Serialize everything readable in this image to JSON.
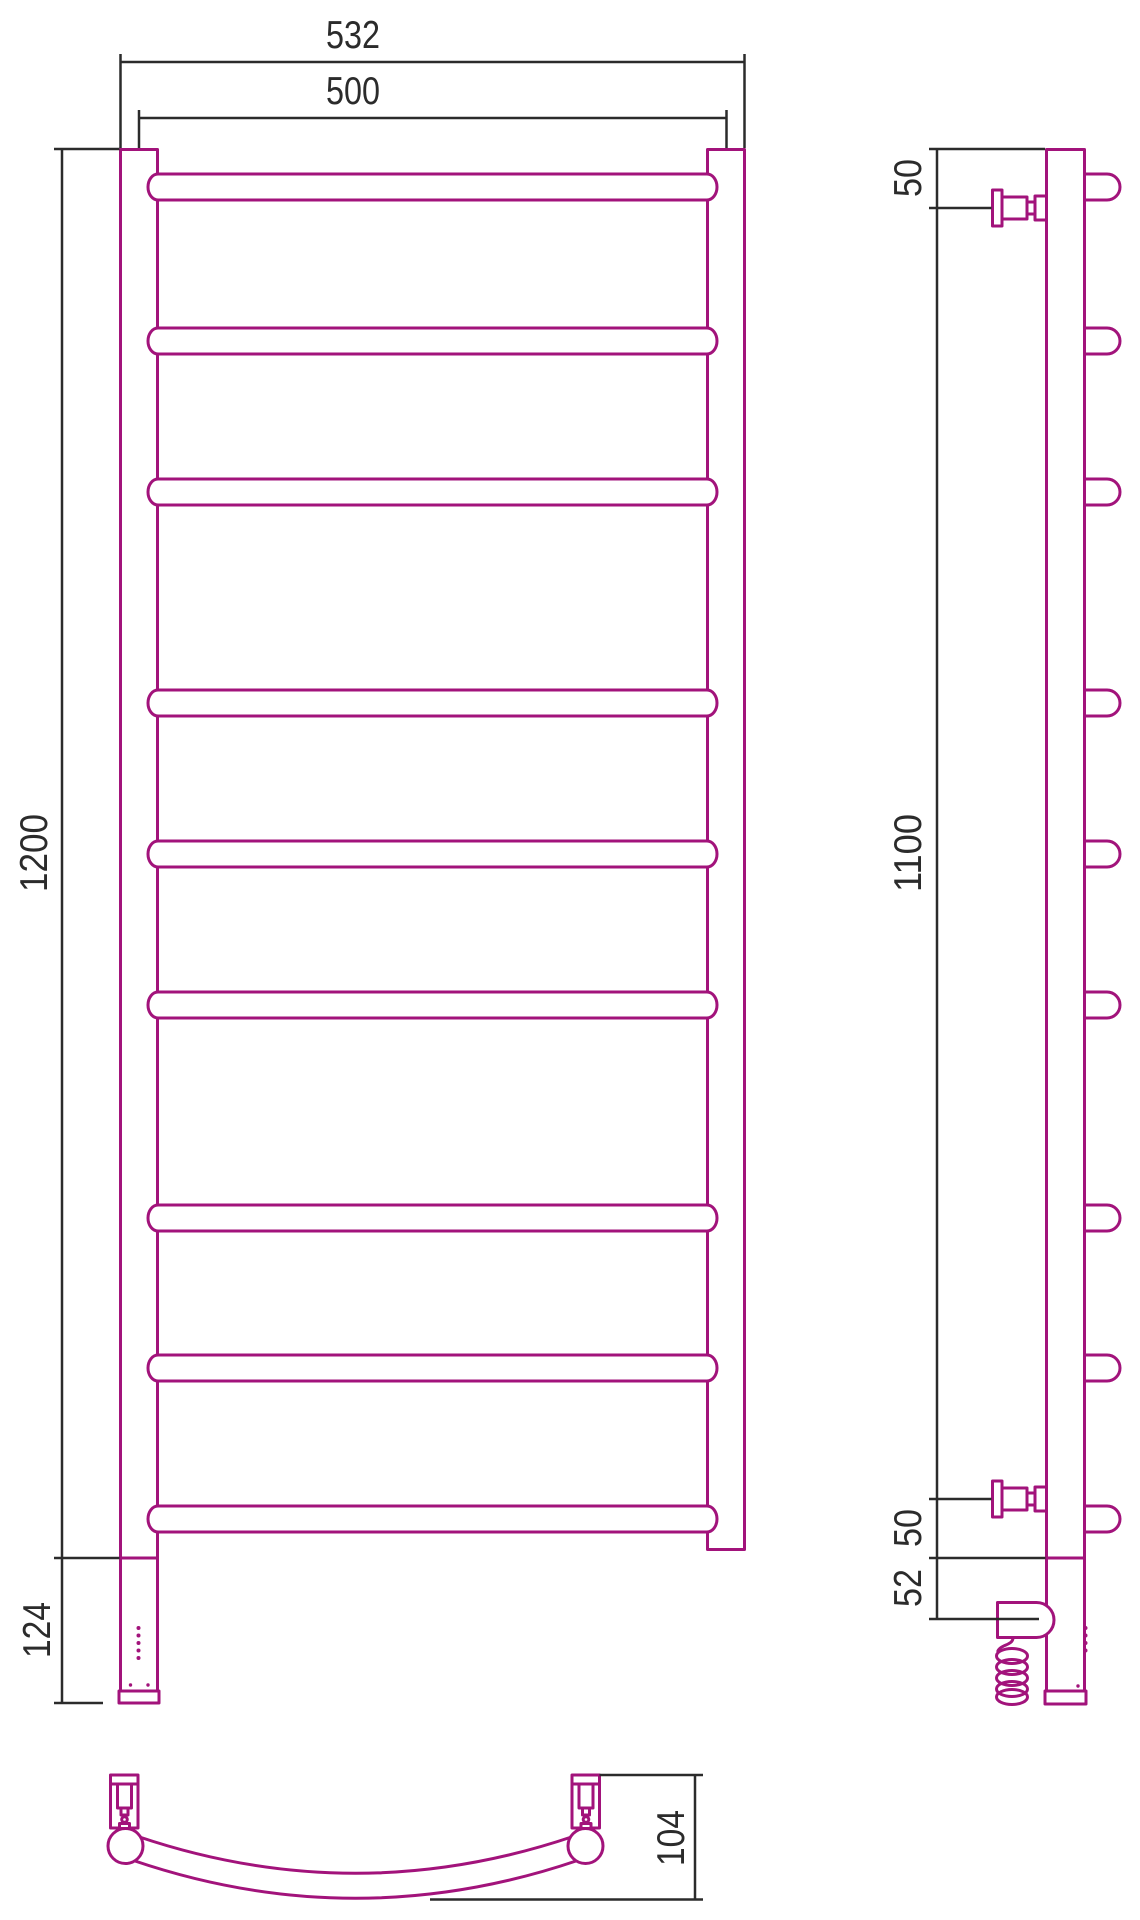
{
  "drawing": {
    "type": "heated-towel-rail-technical-drawing",
    "dimensions": {
      "outer_width": "532",
      "inner_width": "500",
      "total_height": "1200",
      "base_height": "124",
      "side_top_offset": "50",
      "side_mount_height": "1100",
      "side_bottom_offset": "50",
      "side_base_offset": "52",
      "depth": "104"
    },
    "colors": {
      "product": "#a2137b",
      "dimension": "#2b2b2b",
      "background": "#ffffff"
    }
  }
}
